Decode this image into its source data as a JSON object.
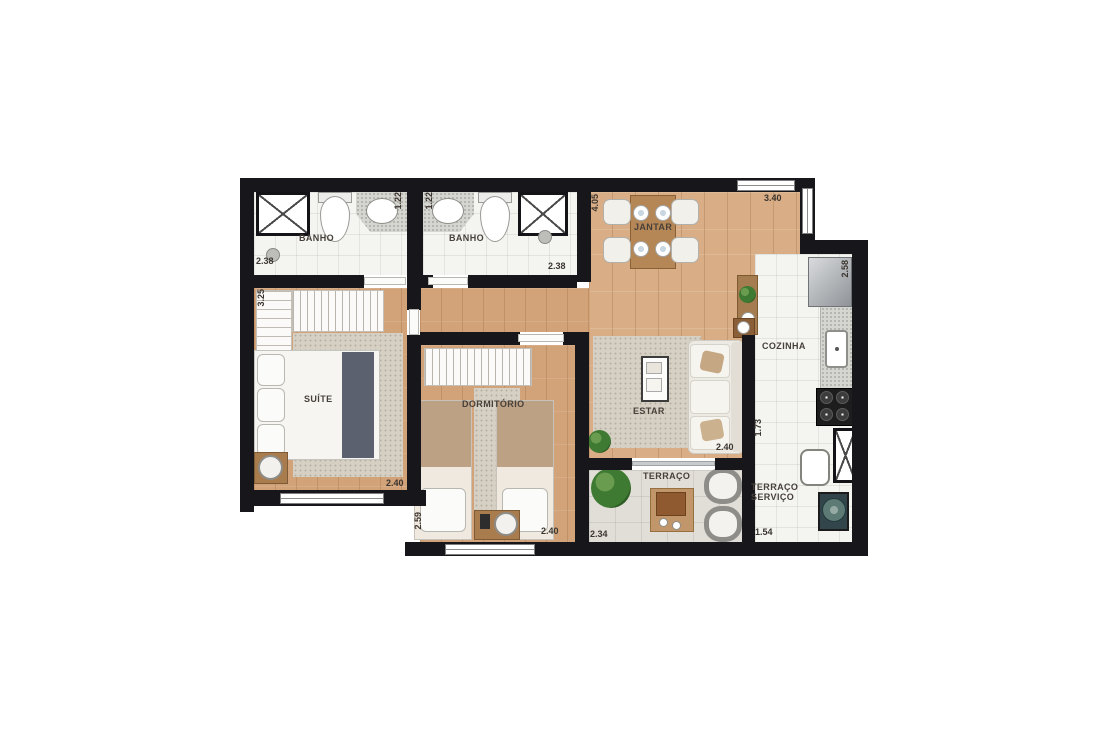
{
  "rooms": {
    "banho_left": {
      "label": "BANHO",
      "dim_width": "2.38",
      "dim_depth": "1.22"
    },
    "banho_right": {
      "label": "BANHO",
      "dim_width": "2.38",
      "dim_depth": "1.22"
    },
    "jantar": {
      "label": "JANTAR",
      "dim_depth": "4.05",
      "dim_width": "3.40"
    },
    "cozinha": {
      "label": "COZINHA",
      "dim_depth": "2.58",
      "dim_width": "1.73"
    },
    "suite": {
      "label": "SUÍTE",
      "dim_depth": "3.25",
      "dim_width": "2.40"
    },
    "dormitorio": {
      "label": "DORMITÓRIO",
      "dim_depth": "2.59",
      "dim_width": "2.40"
    },
    "estar": {
      "label": "ESTAR",
      "dim_width": "2.40"
    },
    "terraco": {
      "label": "TERRAÇO",
      "dim_width": "2.34"
    },
    "terraco_servico": {
      "label_line1": "TERRAÇO",
      "label_line2": "SERVIÇO",
      "dim_width": "1.54"
    }
  },
  "colors": {
    "wall": "#17171b",
    "wood_floor": "#d9ad85",
    "tile_floor": "#f4f4f1",
    "terrace_floor": "#e1ded7",
    "rug": "#d5d0c3",
    "bed_runner": "#5c6170",
    "plant": "#3f7a33"
  }
}
